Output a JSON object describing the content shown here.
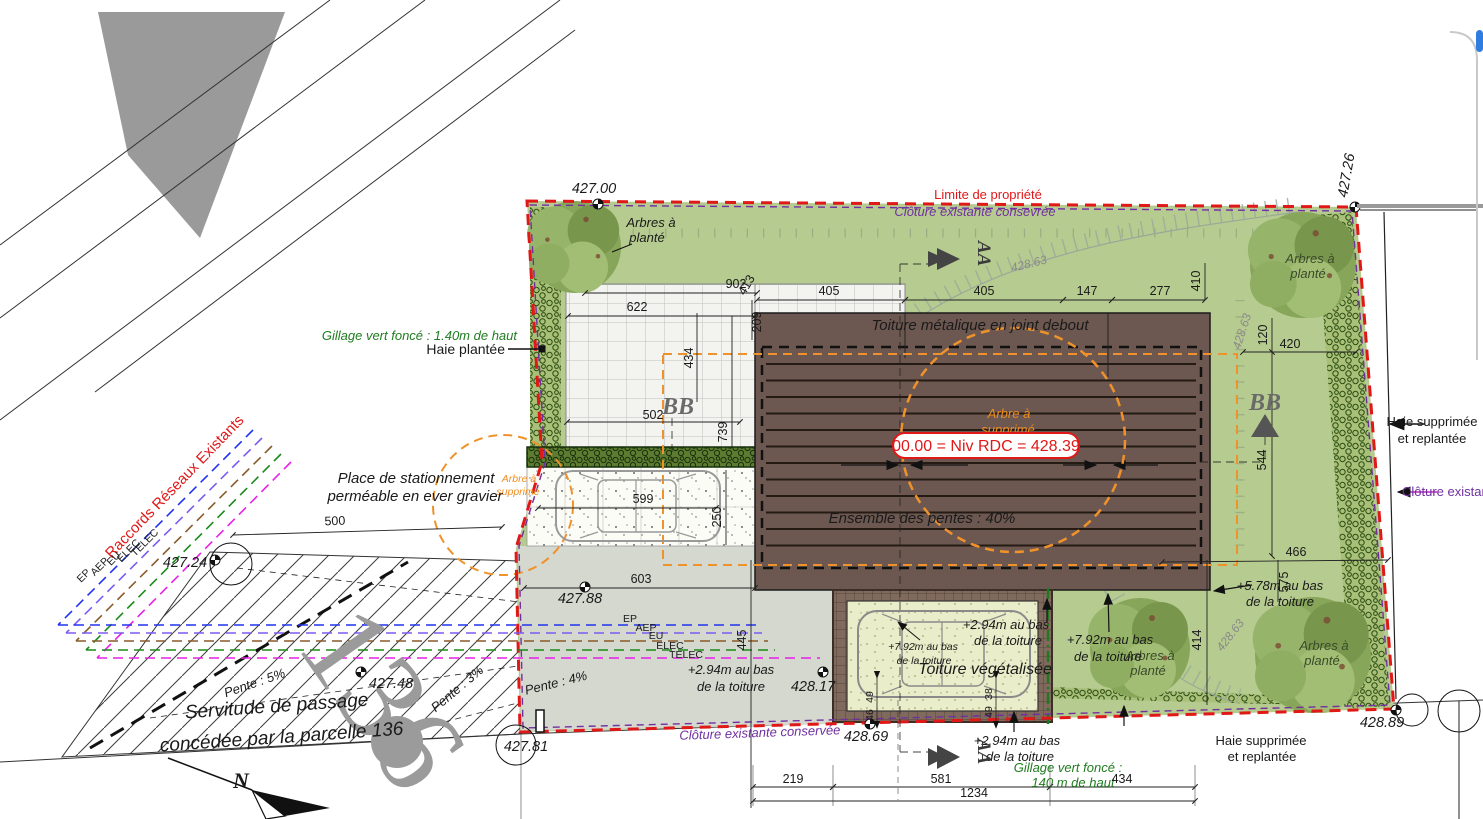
{
  "labels": {
    "limite_propriete": "Limite de propriété",
    "cloture_conservee_top": "Clôture existante consevrée",
    "cloture_conservee_bottom": "Clôture existante conservée",
    "cloture_existante": "Clôture existante",
    "arbres_a": "Arbres à",
    "plante": "planté",
    "arbre_a": "Arbre à",
    "supprime": "supprimé",
    "gillage_140cm": "Gillage vert foncé : 1.40m de haut",
    "gillage_line1": "Gillage vert foncé :",
    "gillage_line2": "140 m de haut",
    "haie_plantee": "Haie plantée",
    "haie_supprimee": "Haie supprimée",
    "et_replantee": "et replantée",
    "toiture_metalique": "Toiture métalique en joint debout",
    "niveau_rdc": "00.00 = Niv RDC = 428.39",
    "ensemble_pentes": "Ensemble des pentes : 40%",
    "toiture_vegetalisee": "Toiture végétalisée",
    "place_line1": "Place de stationnement",
    "place_line2": "perméable en ever gravier",
    "raccords": "Raccords Réseaux Existants",
    "servitude_line1": "Servitude de passage",
    "servitude_line2": "concédée par la parcelle 136",
    "parcelle_136": "136",
    "pente_5": "Pente : 5%",
    "pente_3": "Pente : 3%",
    "pente_4": "Pente : 4%",
    "h294": "+2.94m au bas",
    "h792": "+7.92m au bas",
    "h578": "+5.78m au bas",
    "de_la_toiture": "de la toiture",
    "ep": "EP",
    "aep": "AEP",
    "eu": "EU",
    "elec": "ELEC",
    "telec": "TELEC",
    "aa": "AA",
    "bb": "BB",
    "north_n": "N"
  },
  "levels": {
    "l42700": "427.00",
    "l42726": "427.26",
    "l42724": "427.24",
    "l42748": "427.48",
    "l42788": "427.88",
    "l42781": "427.81",
    "l42817": "428.17",
    "l42869": "428.69",
    "l42889": "428.89",
    "contour": "428.63"
  },
  "dims": {
    "d902": "902",
    "d413": "413",
    "d622": "622",
    "d405": "405",
    "d147": "147",
    "d277": "277",
    "d410": "410",
    "d420": "420",
    "d120": "120",
    "d209": "209",
    "d434": "434",
    "d502": "502",
    "d739": "739",
    "d599": "599",
    "d250": "250",
    "d603": "603",
    "d445": "445",
    "d500": "500",
    "d544": "544",
    "d466": "466",
    "d575": "575",
    "d414": "414",
    "d219": "219",
    "d581": "581",
    "d1234": "1234",
    "d49": "49",
    "d46": "46",
    "d38": "38"
  },
  "colors": {
    "boundary_red": "#e01818",
    "fence_purple": "#7030a0",
    "lawn_green": "#b6cb8f",
    "roof_brown": "#6c5850",
    "orange_dashed": "#f0922b",
    "utility_ep": "#2233ee",
    "utility_aep": "#7b5cf0",
    "utility_eu": "#8b5a2b",
    "utility_elec": "#1a8a1a",
    "utility_telec": "#e820e8",
    "ui_accent_blue": "#2f7de1"
  }
}
